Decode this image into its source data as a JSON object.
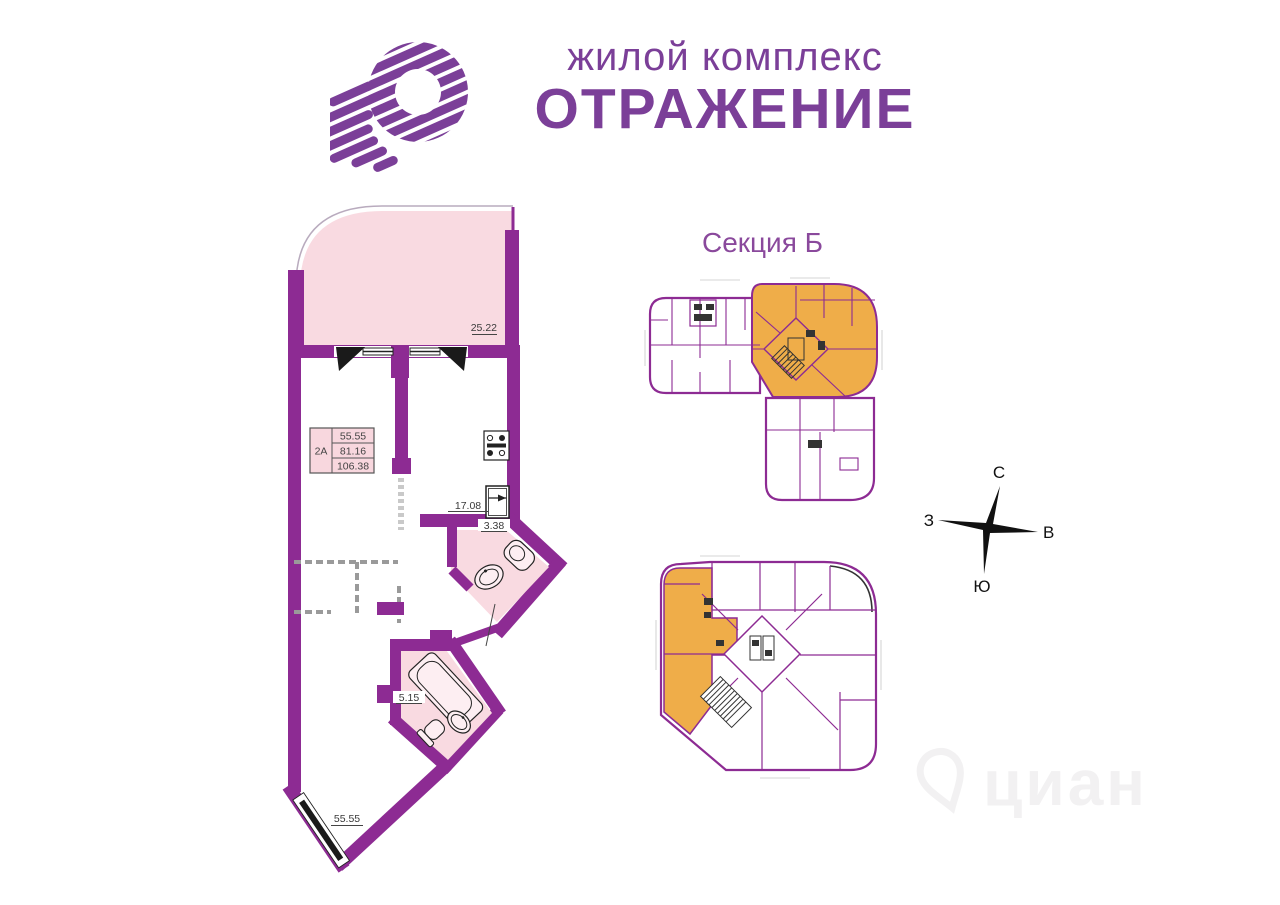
{
  "brand": {
    "tagline": "жилой комплекс",
    "name": "ОТРАЖЕНИЕ"
  },
  "section_label": "Секция Б",
  "apartment": {
    "unit": "2А",
    "area_rows": [
      "55.55",
      "81.16",
      "106.38"
    ],
    "dim_terrace": "25.22",
    "dim_kitchen": "17.08",
    "dim_wc": "3.38",
    "dim_bath": "5.15",
    "dim_living": "55.55"
  },
  "compass": {
    "north": "С",
    "east": "В",
    "south": "Ю",
    "west": "З"
  },
  "watermark": "циан",
  "colors": {
    "wall_purple": "#8d2b93",
    "brand_purple": "#7b3f98",
    "room_pink": "#f9dae1",
    "highlight_orange": "#efad49"
  }
}
